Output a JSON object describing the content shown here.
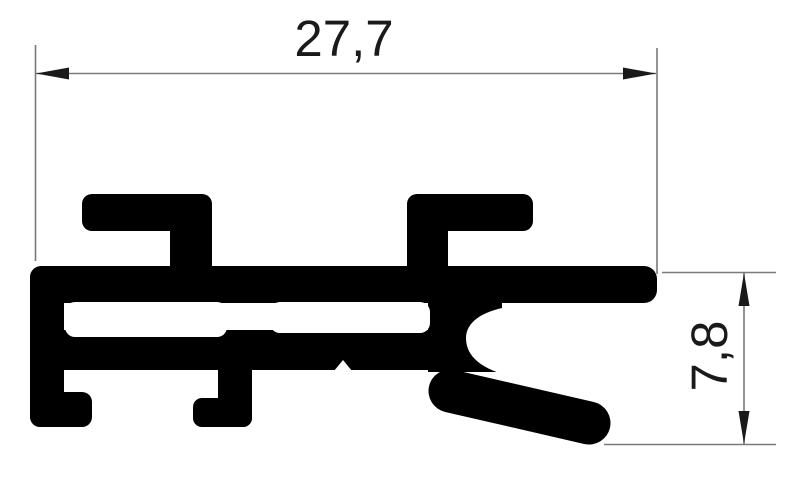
{
  "drawing": {
    "kind": "extrusion-profile-cross-section",
    "dimensions": {
      "width": {
        "value": "27,7"
      },
      "height": {
        "value": "7,8"
      }
    },
    "colors": {
      "profile": "#000000",
      "background": "#ffffff",
      "dimension_lines": "#7a7a7a",
      "arrows": "#1a1a1a",
      "text": "#1a1a1a"
    }
  }
}
